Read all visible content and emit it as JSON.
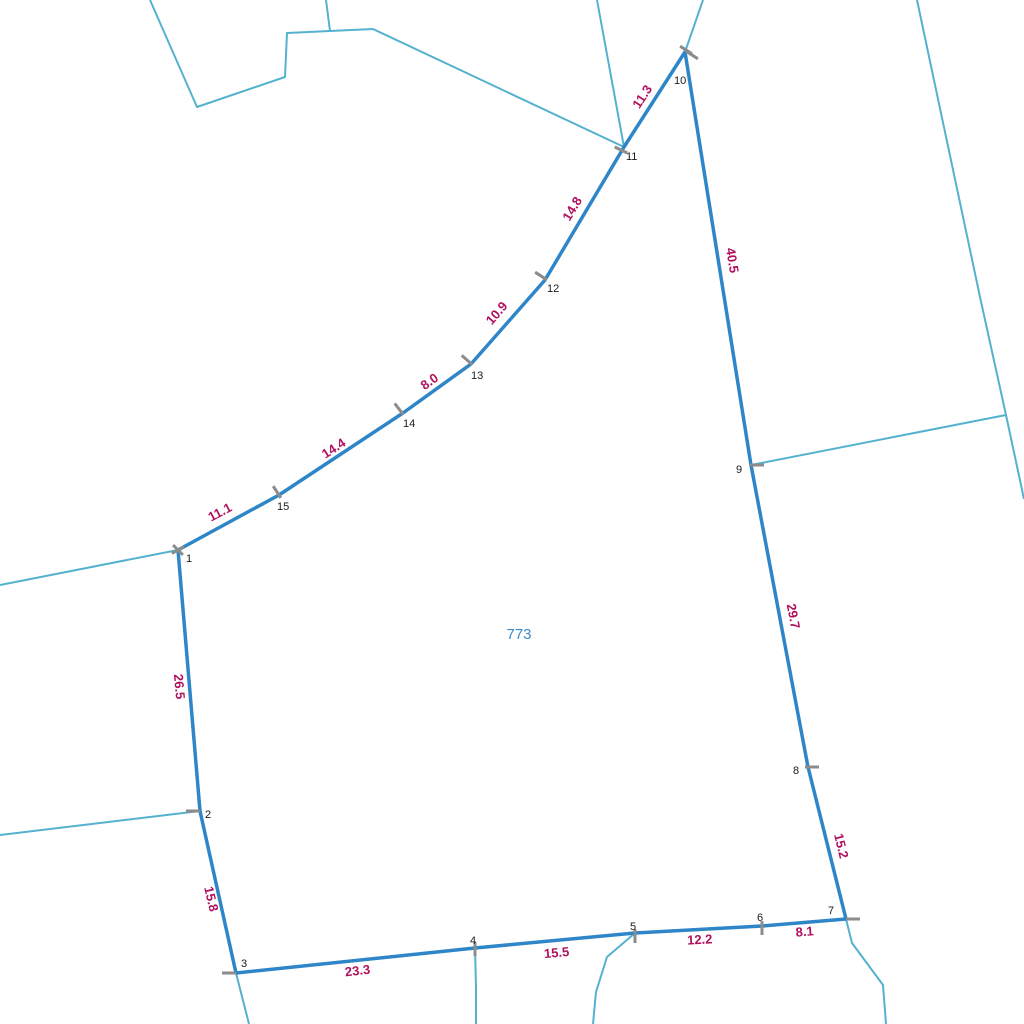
{
  "colors": {
    "boundary": "#2e86c8",
    "adjacent_line": "#54b2cf",
    "edge_label": "#b0115f",
    "vertex_label": "#1a1a1a",
    "parcel_label": "#3d8ac9",
    "tick": "#8c8c8c",
    "background": "#ffffff"
  },
  "parcel": {
    "number": "773"
  },
  "vertices": [
    {
      "label": "1"
    },
    {
      "label": "2"
    },
    {
      "label": "3"
    },
    {
      "label": "4"
    },
    {
      "label": "5"
    },
    {
      "label": "6"
    },
    {
      "label": "7"
    },
    {
      "label": "8"
    },
    {
      "label": "9"
    },
    {
      "label": "10"
    },
    {
      "label": "11"
    },
    {
      "label": "12"
    },
    {
      "label": "13"
    },
    {
      "label": "14"
    },
    {
      "label": "15"
    }
  ],
  "edges": [
    {
      "from": "1",
      "to": "2",
      "length": "26.5"
    },
    {
      "from": "2",
      "to": "3",
      "length": "15.8"
    },
    {
      "from": "3",
      "to": "4",
      "length": "23.3"
    },
    {
      "from": "4",
      "to": "5",
      "length": "15.5"
    },
    {
      "from": "5",
      "to": "6",
      "length": "12.2"
    },
    {
      "from": "6",
      "to": "7",
      "length": "8.1"
    },
    {
      "from": "7",
      "to": "8",
      "length": "15.2"
    },
    {
      "from": "8",
      "to": "9",
      "length": "29.7"
    },
    {
      "from": "9",
      "to": "10",
      "length": "40.5"
    },
    {
      "from": "10",
      "to": "11",
      "length": "11.3"
    },
    {
      "from": "11",
      "to": "12",
      "length": "14.8"
    },
    {
      "from": "12",
      "to": "13",
      "length": "10.9"
    },
    {
      "from": "13",
      "to": "14",
      "length": "8.0"
    },
    {
      "from": "14",
      "to": "15",
      "length": "14.4"
    },
    {
      "from": "15",
      "to": "1",
      "length": "11.1"
    }
  ]
}
